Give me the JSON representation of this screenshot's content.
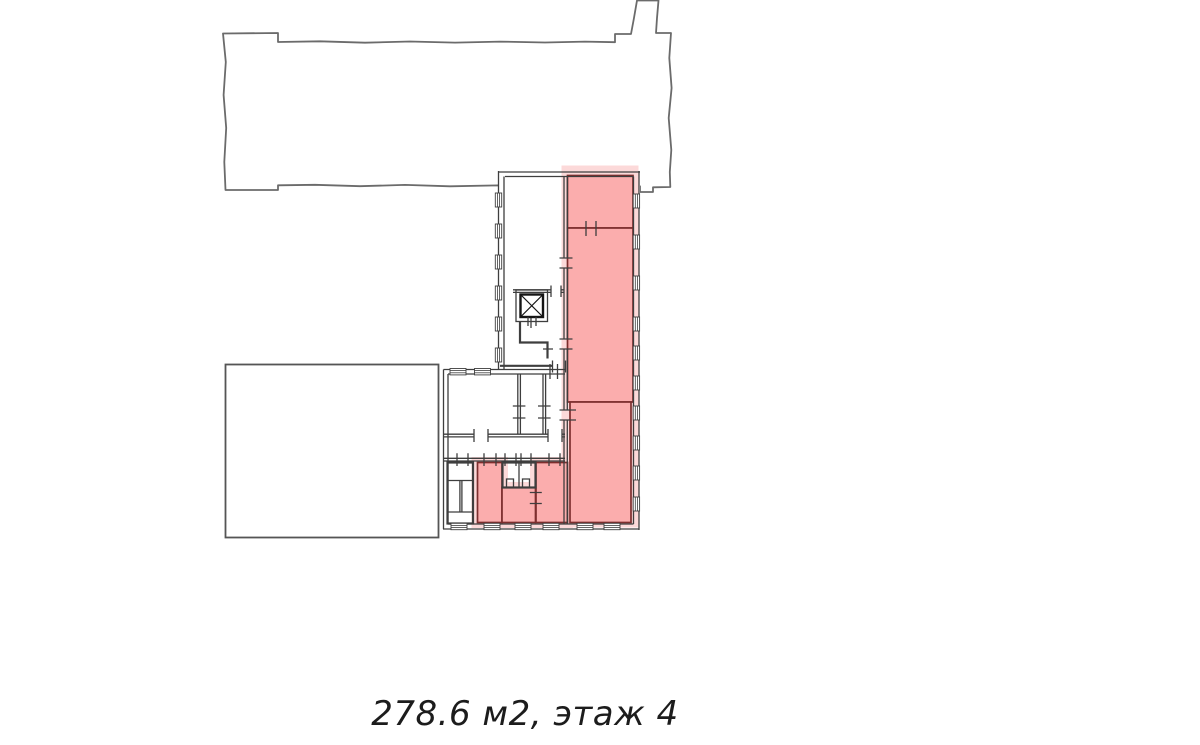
{
  "caption": {
    "text": "278.6 м2, этаж 4"
  },
  "colors": {
    "background": "#ffffff",
    "outline": "#6b6b6b",
    "annex_outline": "#555555",
    "wall": "#3e3e3e",
    "wall_dark": "#141414",
    "highlight_fill": "#fbadad",
    "highlight_halo": "#fcd9d9",
    "highlight_border": "#7d2e2e",
    "caption_text": "#1c1c1c"
  }
}
